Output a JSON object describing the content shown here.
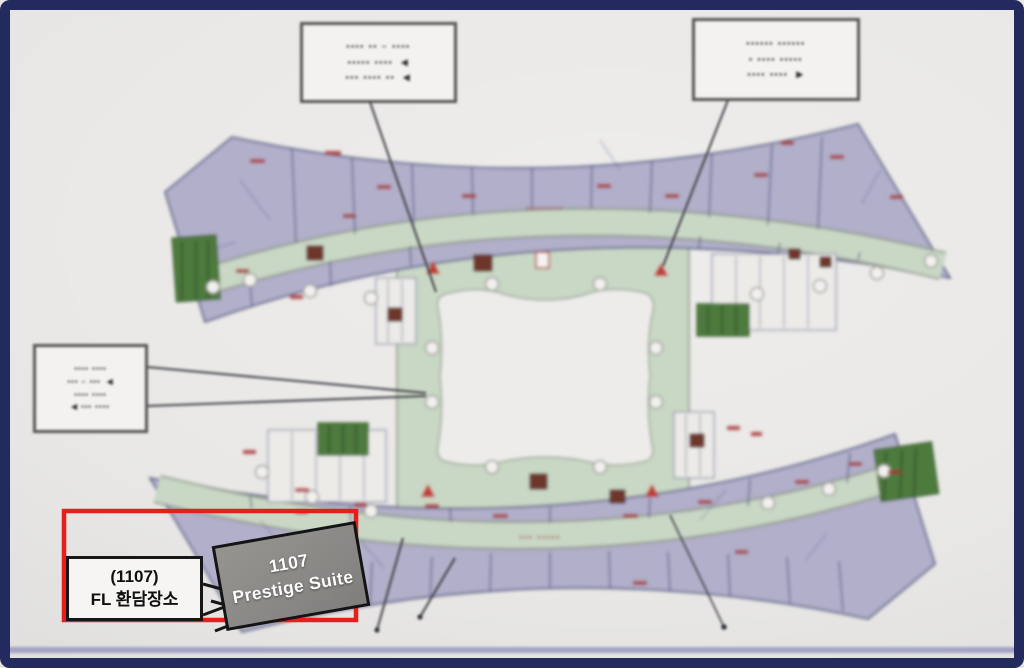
{
  "frame": {
    "border_color": "#232a5e",
    "background": "#e9e8e6"
  },
  "highlight": {
    "color": "#e71f1c"
  },
  "suite_callout": {
    "line1": "1107",
    "line2": "Prestige Suite"
  },
  "location_callout": {
    "line1": "(1107)",
    "line2": "FL 환담장소"
  },
  "photo_callouts": {
    "top_left": {
      "line1": "▪▪▪▪ ▪▪ – ▪▪▪▪",
      "line2": "▪▪▪▪▪ ▪▪▪▪  ◀",
      "line3": "▪▪▪ ▪▪▪▪ ▪▪  ◀"
    },
    "top_right": {
      "line1": "▪▪▪▪▪▪ ▪▪▪▪▪▪",
      "line2": "▪ ▪▪▪▪ ▪▪▪▪▪",
      "line3": "▪▪▪▪ ▪▪▪▪  ▶"
    },
    "left": {
      "line1": "▪▪▪▪ ▪▪▪▪",
      "line2": "▪▪▪ – ▪▪▪  ◀",
      "line3": "▪▪▪▪ ▪▪▪▪",
      "line4": "◀ ▪▪▪ ▪▪▪▪"
    }
  },
  "plan": {
    "corridor_label_top": "▪▪▪▪▪▪▪▪",
    "corridor_label_bottom": "▪▪▪ ▪▪▪▪▪",
    "colors": {
      "rooms": "#b1afc9",
      "corridor": "#c9d7c5",
      "corridor_edge": "#8a9383",
      "courtyard": "#edecea",
      "garden": "#4e7a3e",
      "marker": "#a63434"
    }
  }
}
